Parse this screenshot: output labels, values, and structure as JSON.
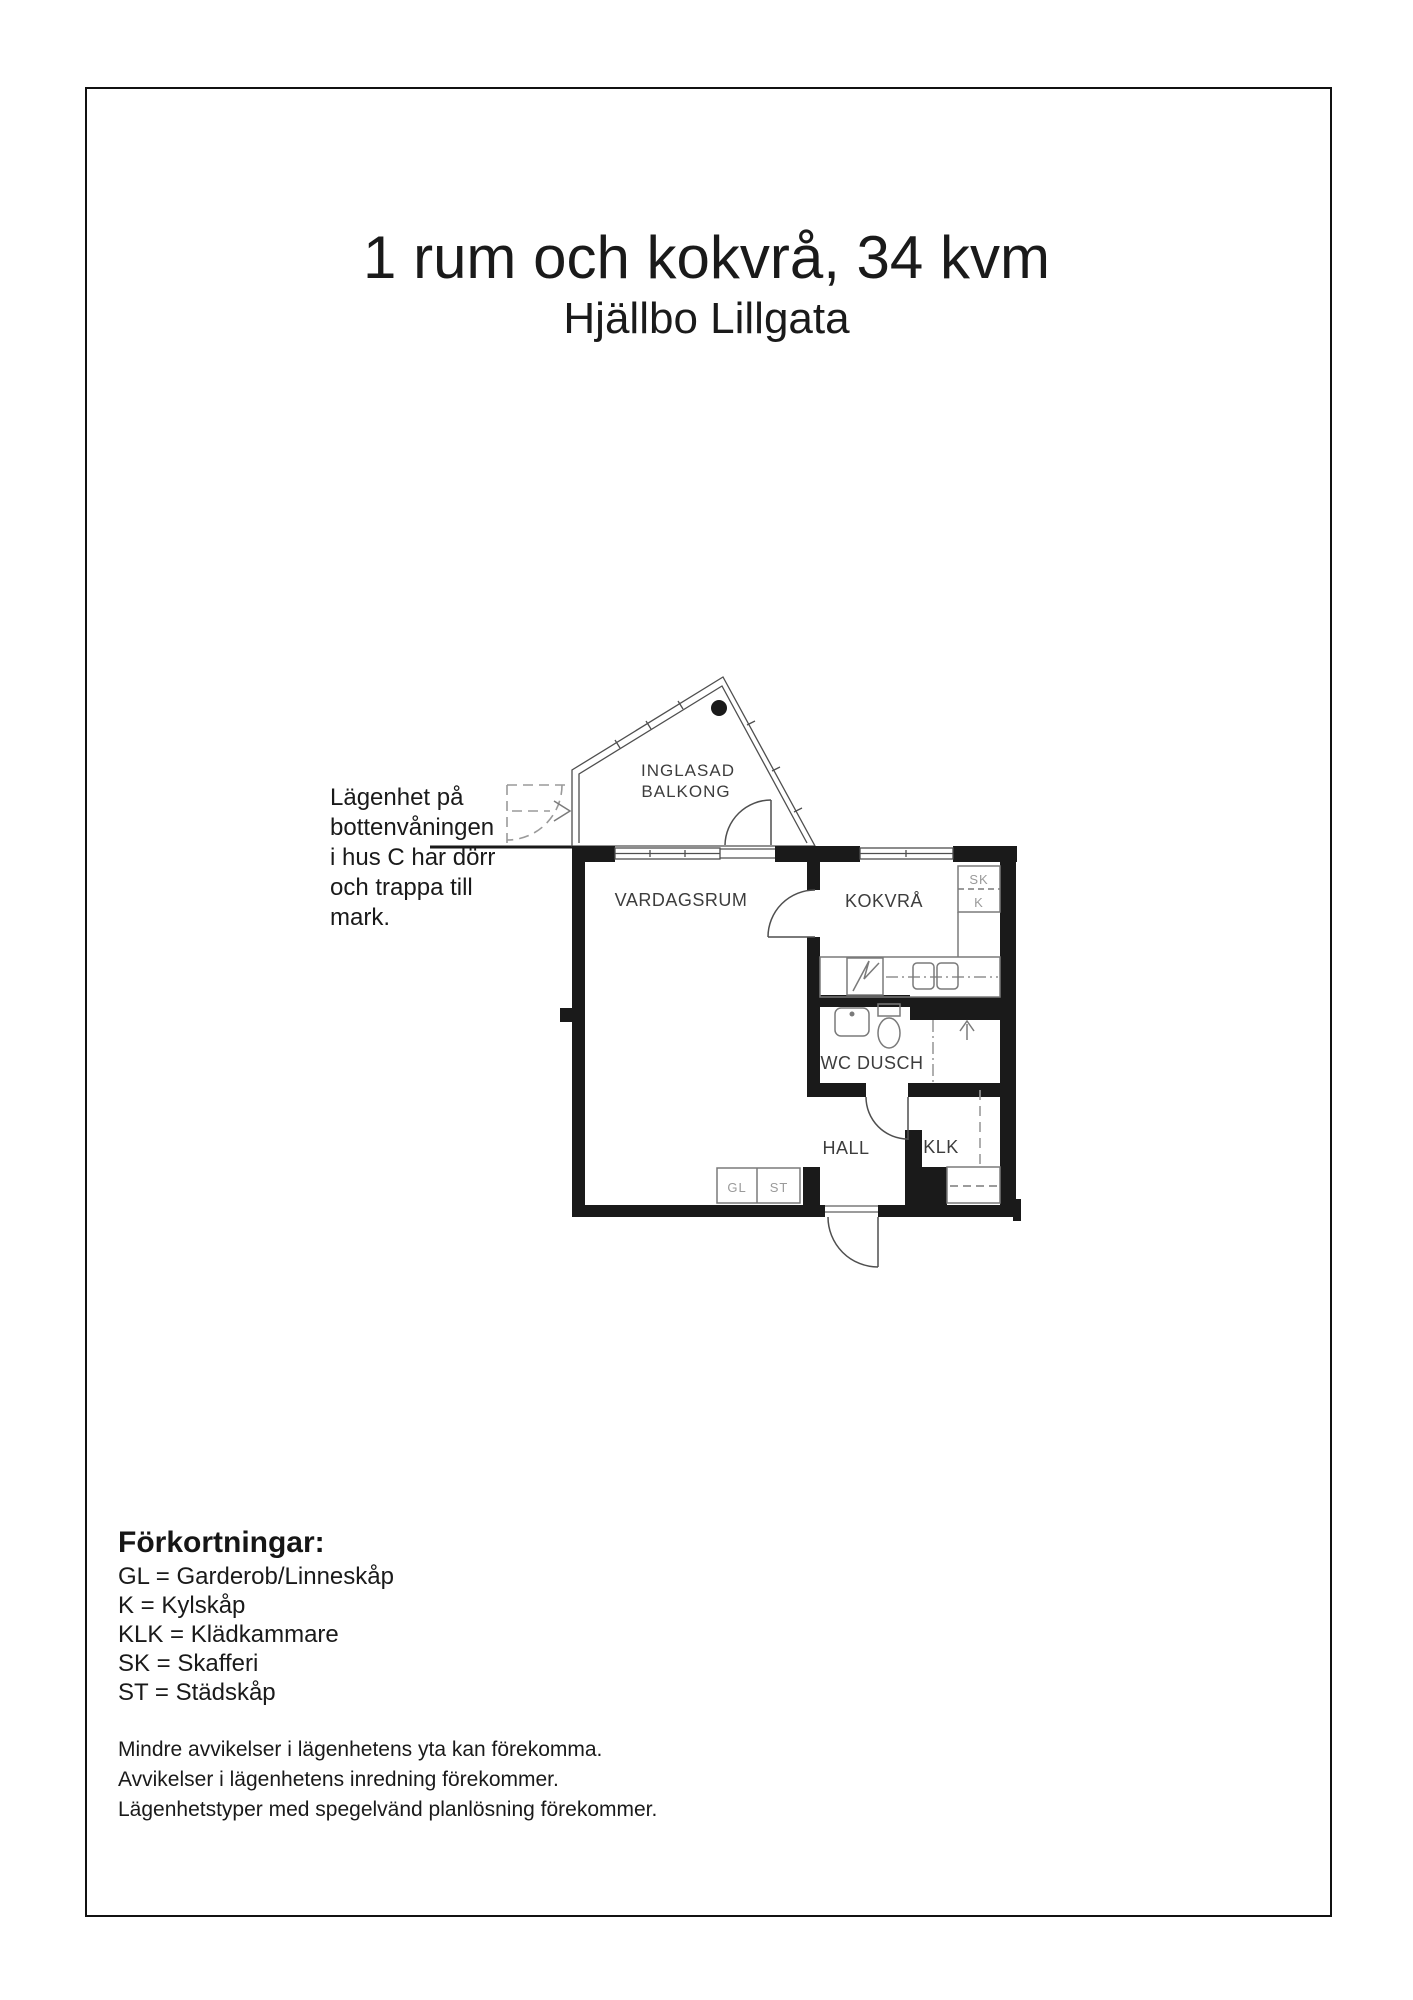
{
  "page": {
    "title": "1 rum och kokvrå, 34 kvm",
    "subtitle": "Hjällbo Lillgata"
  },
  "annotation": {
    "lines": [
      "Lägenhet på",
      "bottenvåningen",
      "i hus C har dörr",
      "och trappa till",
      "mark."
    ]
  },
  "floorplan": {
    "balcony_line1": "INGLASAD",
    "balcony_line2": "BALKONG",
    "living_room": "VARDAGSRUM",
    "kitchen": "KOKVRÅ",
    "wc": "WC DUSCH",
    "hall": "HALL",
    "klk": "KLK",
    "sk": "SK",
    "k": "K",
    "gl": "GL",
    "st": "ST"
  },
  "abbreviations": {
    "heading": "Förkortningar:",
    "items": [
      "GL = Garderob/Linneskåp",
      "K = Kylskåp",
      "KLK = Klädkammare",
      "SK = Skafferi",
      "ST = Städskåp"
    ]
  },
  "footer": {
    "lines": [
      "Mindre avvikelser i lägenhetens yta kan förekomma.",
      "Avvikelser i lägenhetens inredning förekommer.",
      "Lägenhetstyper med spegelvänd planlösning förekommer."
    ]
  },
  "colors": {
    "wall": "#1a1a1a",
    "thin_line": "#4f4f4f",
    "fixture_line": "#7a7a7a",
    "dashed_line": "#9a9a9a",
    "label": "#3d3d3d",
    "closet_label": "#9a9a9a"
  }
}
